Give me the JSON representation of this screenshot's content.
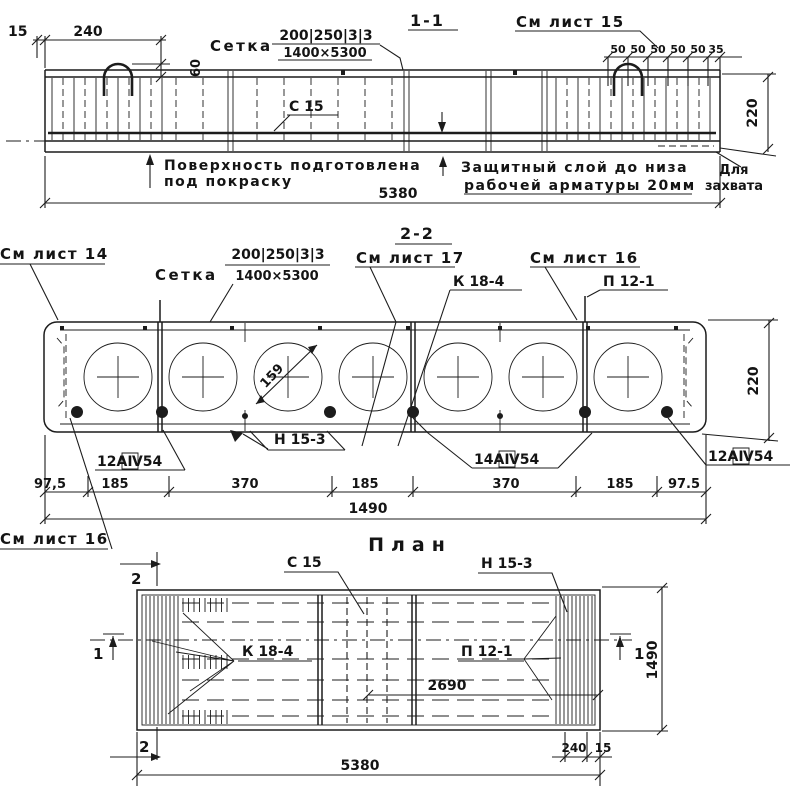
{
  "section_1_1": {
    "title": "1-1",
    "see_sheet": "См лист 15",
    "mesh_word": "Сетка",
    "mesh_top": "200|250|3|3",
    "mesh_bottom": "1400×5300",
    "label_c15": "С 15",
    "dim_15": "15",
    "dim_240": "240",
    "dim_60": "60",
    "dim_220": "220",
    "dim_5380": "5380",
    "top_dims": [
      "50",
      "50",
      "50",
      "50",
      "50",
      "35"
    ],
    "note_surface": [
      "Поверхность подготовлена",
      "под покраску"
    ],
    "note_cover": [
      "Защитный слой до низа",
      "рабочей арматуры 20мм"
    ],
    "note_grip": [
      "Для",
      "захвата"
    ]
  },
  "section_2_2": {
    "title": "2-2",
    "see_sheet_14": "См лист 14",
    "see_sheet_17": "См лист 17",
    "see_sheet_16": "См лист 16",
    "see_sheet_16_bottom": "См лист 16",
    "mesh_word": "Сетка",
    "mesh_top": "200|250|3|3",
    "mesh_bottom": "1400×5300",
    "label_k18": "К 18-4",
    "label_p12": "П 12-1",
    "label_n15": "Н 15-3",
    "bar_left": "12АⅣ54",
    "bar_mid": "14АⅣ54",
    "bar_right": "12АⅣ54",
    "void_diameter": "159",
    "dim_220": "220",
    "dim_1490": "1490",
    "bottom_dims": [
      "97,5",
      "185",
      "370",
      "185",
      "370",
      "185",
      "97.5"
    ]
  },
  "plan": {
    "title": "План",
    "label_c15": "С 15",
    "label_n15": "Н 15-3",
    "label_k18": "К 18-4",
    "label_p12": "П 12-1",
    "dim_2690": "2690",
    "dim_1490": "1490",
    "dim_240": "240",
    "dim_15": "15",
    "dim_5380": "5380",
    "marker_2_top": "2",
    "marker_2_bottom": "2",
    "marker_1_left": "1",
    "marker_1_right": "1"
  },
  "colors": {
    "ink": "#1c1c1c",
    "paper": "#ffffff"
  }
}
